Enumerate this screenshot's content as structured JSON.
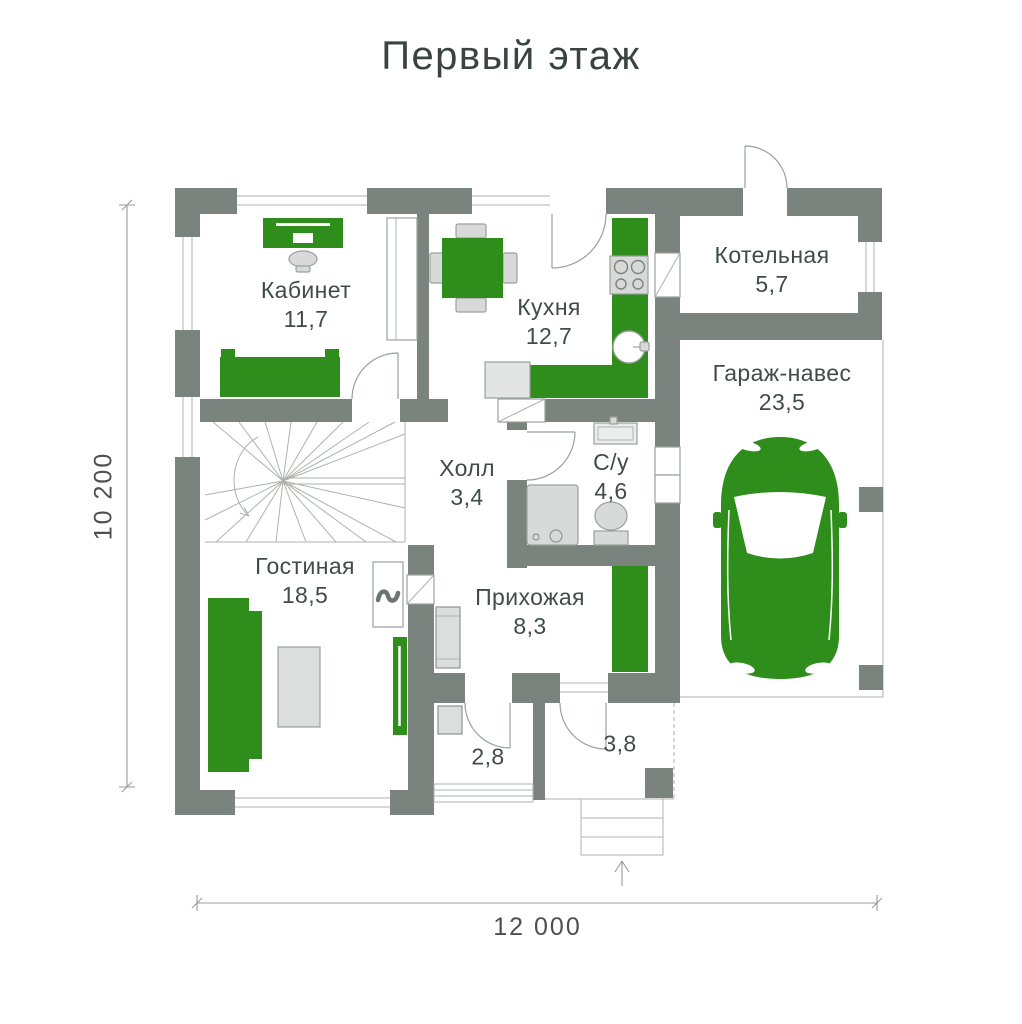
{
  "title": "Первый этаж",
  "dimensions": {
    "vertical": "10 200",
    "horizontal": "12 000"
  },
  "rooms": {
    "office": {
      "name": "Кабинет",
      "area": "11,7"
    },
    "kitchen": {
      "name": "Кухня",
      "area": "12,7"
    },
    "boiler_room": {
      "name": "Котельная",
      "area": "5,7"
    },
    "garage": {
      "name": "Гараж-навес",
      "area": "23,5"
    },
    "hall": {
      "name": "Холл",
      "area": "3,4"
    },
    "bathroom": {
      "name": "С/у",
      "area": "4,6"
    },
    "living_room": {
      "name": "Гостиная",
      "area": "18,5"
    },
    "entryway": {
      "name": "Прихожая",
      "area": "8,3"
    },
    "vestibule": {
      "area": "2,8"
    },
    "porch": {
      "area": "3,8"
    }
  },
  "icons": [
    "car-icon",
    "fireplace-flame-icon",
    "stairs-icon",
    "stove-icon",
    "sink-icon",
    "shower-icon",
    "toilet-icon",
    "entrance-arrow-icon"
  ],
  "colors": {
    "wall": "#7b837e",
    "accent_green": "#2f8d1b",
    "furniture": "#d8dad9",
    "outline": "#9aa09c",
    "text": "#414c46",
    "dimension_text": "#4f4f4f",
    "title_text": "#3a443e"
  }
}
